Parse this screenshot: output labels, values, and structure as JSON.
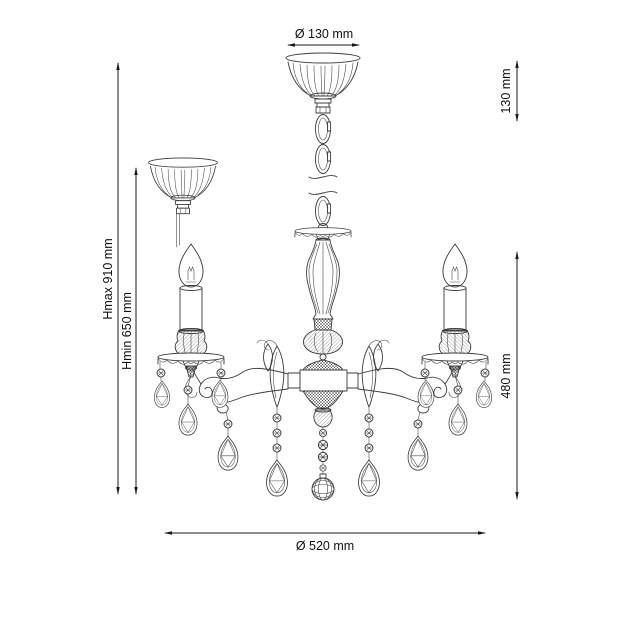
{
  "dimensions": {
    "canopy_diameter": "Ø 130 mm",
    "mount_height": "130 mm",
    "height_max": "Hmax 910 mm",
    "height_min": "Hmin 650 mm",
    "body_height": "480 mm",
    "body_diameter": "Ø 520 mm"
  },
  "colors": {
    "background": "#ffffff",
    "drawing_line": "#3c3c3c",
    "dimension_line": "#1a1a1a",
    "text": "#111111"
  }
}
